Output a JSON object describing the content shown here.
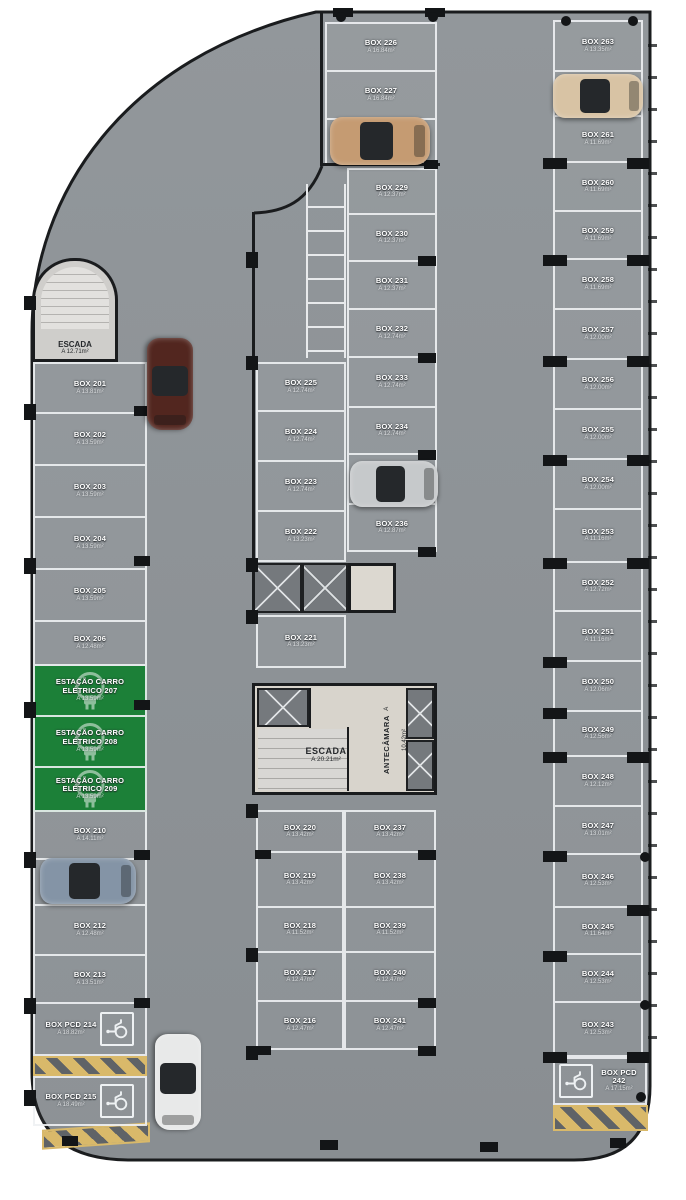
{
  "plan_title": "Parking level floor plan",
  "colors": {
    "slab": "#8e9397",
    "line": "#eef1f3",
    "wall": "#1a1c1e",
    "ev_green": "#1c8038",
    "hatch_yellow": "#d9b96a"
  },
  "icons": {
    "wheelchair": "wheelchair-accessible-symbol",
    "ev_plug": "ev-charging-plug",
    "elevator_x": "elevator-shaft-cross"
  },
  "stairs_top": {
    "label": "ESCADA",
    "area": "A 12.71m²"
  },
  "core": {
    "stairs_label": "ESCADA",
    "stairs_area": "A 20.21m²",
    "antechamber_label": "ANTECÂMARA",
    "antechamber_area": "A 10.42m²"
  },
  "columns": {
    "left": [
      {
        "label": "BOX 201",
        "area": "A 13.81m²",
        "type": "box"
      },
      {
        "label": "BOX 202",
        "area": "A 13.59m²",
        "type": "box"
      },
      {
        "label": "BOX 203",
        "area": "A 13.59m²",
        "type": "box"
      },
      {
        "label": "BOX 204",
        "area": "A 13.59m²",
        "type": "box"
      },
      {
        "label": "BOX 205",
        "area": "A 13.59m²",
        "type": "box"
      },
      {
        "label": "BOX 206",
        "area": "A 12.48m²",
        "type": "box"
      },
      {
        "label": "ESTAÇÃO CARRO ELÉTRICO 207",
        "area": "A 13.59m²",
        "type": "ev"
      },
      {
        "label": "ESTAÇÃO CARRO ELÉTRICO 208",
        "area": "A 13.59m²",
        "type": "ev"
      },
      {
        "label": "ESTAÇÃO CARRO ELÉTRICO 209",
        "area": "A 13.59m²",
        "type": "ev"
      },
      {
        "label": "BOX 210",
        "area": "A 14.11m²",
        "type": "box"
      },
      {
        "label": "BOX 211",
        "area": "A 12.48m²",
        "type": "box"
      },
      {
        "label": "BOX 212",
        "area": "A 12.48m²",
        "type": "box"
      },
      {
        "label": "BOX 213",
        "area": "A 13.51m²",
        "type": "box"
      },
      {
        "label": "BOX PCD 214",
        "area": "A 18.82m²",
        "type": "pcd"
      }
    ],
    "pcd_215": {
      "label": "BOX PCD 215",
      "area": "A 18.49m²",
      "type": "pcd"
    },
    "top_mid": [
      {
        "label": "BOX 226",
        "area": "A 16.84m²",
        "type": "box"
      },
      {
        "label": "BOX 227",
        "area": "A 16.84m²",
        "type": "box"
      },
      {
        "label": "BOX 228",
        "area": "A 16.84m²",
        "type": "box"
      }
    ],
    "mid_upper_left": [
      {
        "label": "BOX 225",
        "area": "A 12.74m²",
        "type": "box"
      },
      {
        "label": "BOX 224",
        "area": "A 12.74m²",
        "type": "box"
      },
      {
        "label": "BOX 223",
        "area": "A 12.74m²",
        "type": "box"
      },
      {
        "label": "BOX 222",
        "area": "A 13.23m²",
        "type": "box"
      }
    ],
    "box_221": {
      "label": "BOX 221",
      "area": "A 13.23m²",
      "type": "box"
    },
    "mid_upper_right": [
      {
        "label": "BOX 229",
        "area": "A 12.37m²",
        "type": "box"
      },
      {
        "label": "BOX 230",
        "area": "A 12.37m²",
        "type": "box"
      },
      {
        "label": "BOX 231",
        "area": "A 12.37m²",
        "type": "box"
      },
      {
        "label": "BOX 232",
        "area": "A 12.74m²",
        "type": "box"
      },
      {
        "label": "BOX 233",
        "area": "A 12.74m²",
        "type": "box"
      },
      {
        "label": "BOX 234",
        "area": "A 12.74m²",
        "type": "box"
      },
      {
        "label": "BOX 235",
        "area": "A 12.74m²",
        "type": "box"
      },
      {
        "label": "BOX 236",
        "area": "A 12.87m²",
        "type": "box"
      }
    ],
    "bottom_left": [
      {
        "label": "BOX 220",
        "area": "A 13.42m²",
        "type": "box"
      },
      {
        "label": "BOX 219",
        "area": "A 13.42m²",
        "type": "box"
      },
      {
        "label": "BOX 218",
        "area": "A 11.52m²",
        "type": "box"
      },
      {
        "label": "BOX 217",
        "area": "A 12.47m²",
        "type": "box"
      },
      {
        "label": "BOX 216",
        "area": "A 12.47m²",
        "type": "box"
      }
    ],
    "bottom_right": [
      {
        "label": "BOX 237",
        "area": "A 13.42m²",
        "type": "box"
      },
      {
        "label": "BOX 238",
        "area": "A 13.42m²",
        "type": "box"
      },
      {
        "label": "BOX 239",
        "area": "A 11.52m²",
        "type": "box"
      },
      {
        "label": "BOX 240",
        "area": "A 12.47m²",
        "type": "box"
      },
      {
        "label": "BOX 241",
        "area": "A 12.47m²",
        "type": "box"
      }
    ],
    "right": [
      {
        "label": "BOX 263",
        "area": "A 13.35m²",
        "type": "box"
      },
      {
        "label": "BOX 262",
        "area": "A 11.69m²",
        "type": "box"
      },
      {
        "label": "BOX 261",
        "area": "A 11.69m²",
        "type": "box"
      },
      {
        "label": "BOX 260",
        "area": "A 11.69m²",
        "type": "box"
      },
      {
        "label": "BOX 259",
        "area": "A 11.69m²",
        "type": "box"
      },
      {
        "label": "BOX 258",
        "area": "A 11.69m²",
        "type": "box"
      },
      {
        "label": "BOX 257",
        "area": "A 12.00m²",
        "type": "box"
      },
      {
        "label": "BOX 256",
        "area": "A 12.00m²",
        "type": "box"
      },
      {
        "label": "BOX 255",
        "area": "A 12.00m²",
        "type": "box"
      },
      {
        "label": "BOX 254",
        "area": "A 12.00m²",
        "type": "box"
      },
      {
        "label": "BOX 253",
        "area": "A 11.16m²",
        "type": "box"
      },
      {
        "label": "BOX 252",
        "area": "A 12.72m²",
        "type": "box"
      },
      {
        "label": "BOX 251",
        "area": "A 11.16m²",
        "type": "box"
      },
      {
        "label": "BOX 250",
        "area": "A 12.06m²",
        "type": "box"
      },
      {
        "label": "BOX 249",
        "area": "A 12.56m²",
        "type": "box"
      },
      {
        "label": "BOX 248",
        "area": "A 12.12m²",
        "type": "box"
      },
      {
        "label": "BOX 247",
        "area": "A 13.01m²",
        "type": "box"
      },
      {
        "label": "BOX 246",
        "area": "A 12.53m²",
        "type": "box"
      },
      {
        "label": "BOX 245",
        "area": "A 11.64m²",
        "type": "box"
      },
      {
        "label": "BOX 244",
        "area": "A 12.53m²",
        "type": "box"
      },
      {
        "label": "BOX 243",
        "area": "A 12.53m²",
        "type": "box"
      }
    ],
    "pcd_242": {
      "label": "BOX PCD 242",
      "area": "A 17.15m²",
      "type": "pcd"
    }
  }
}
